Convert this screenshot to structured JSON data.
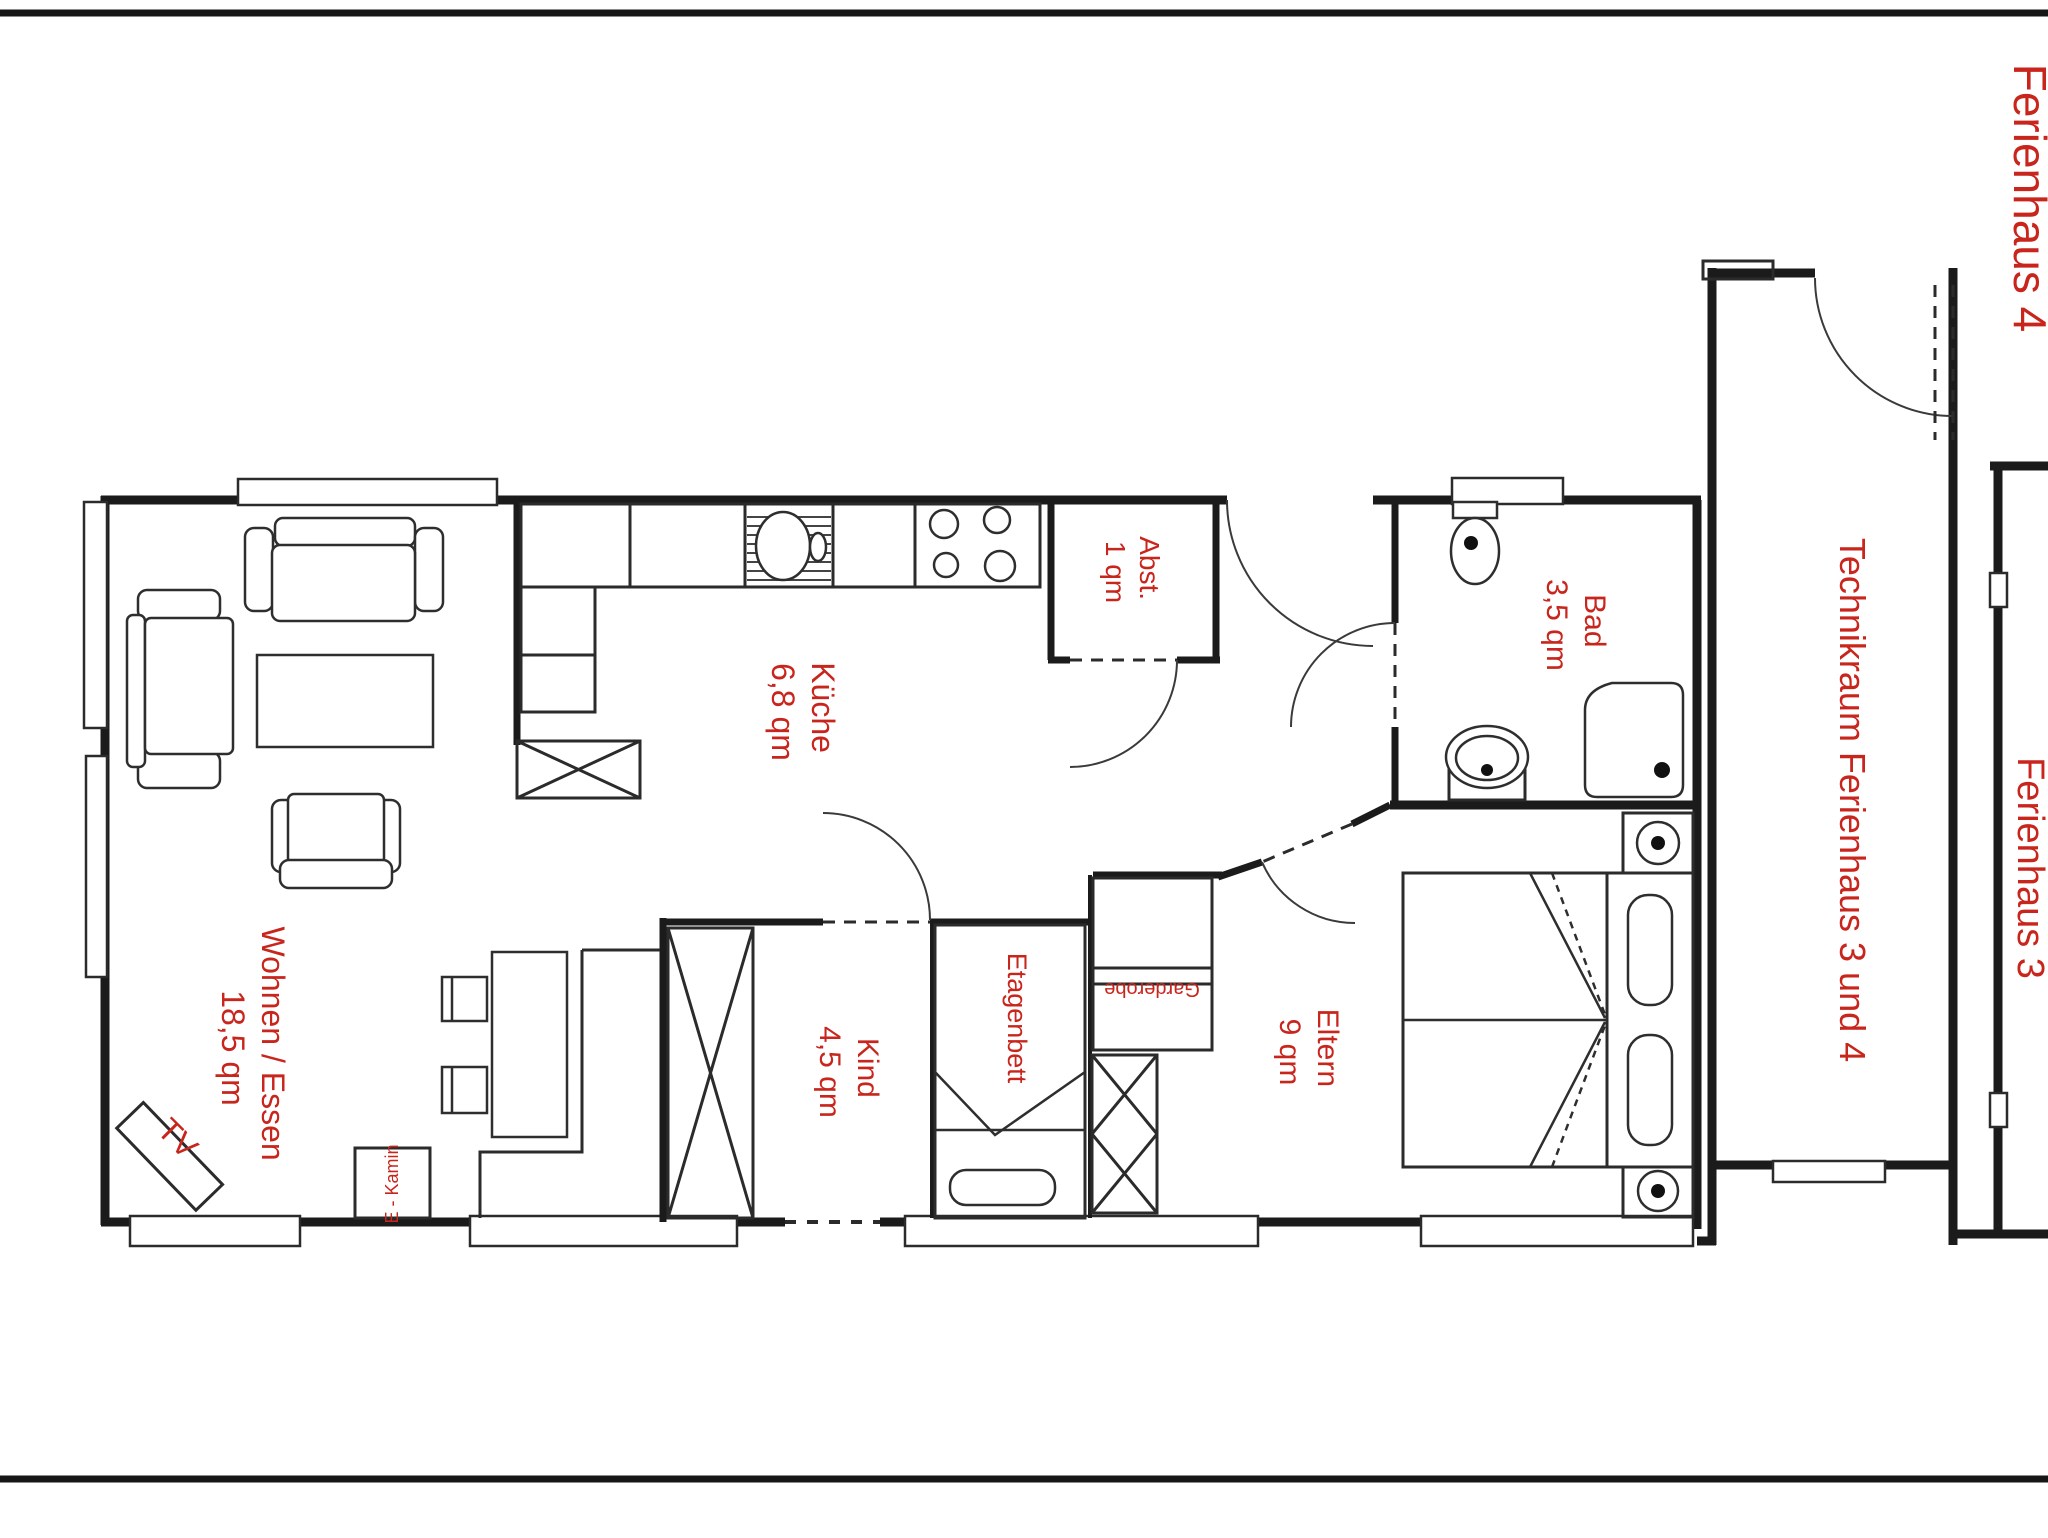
{
  "title": {
    "text": "Ferienhaus 4"
  },
  "colors": {
    "label_red": "#c8251d",
    "wall_black": "#1b1b1b"
  },
  "rooms": [
    {
      "id": "wohnen",
      "name": "Wohnen / Essen",
      "area": "18,5 qm"
    },
    {
      "id": "kueche",
      "name": "Küche",
      "area": "6,8 qm"
    },
    {
      "id": "abstellraum",
      "name": "Abst.",
      "area": "1 qm"
    },
    {
      "id": "bad",
      "name": "Bad",
      "area": "3,5 qm"
    },
    {
      "id": "kind",
      "name": "Kind",
      "area": "4,5 qm"
    },
    {
      "id": "eltern",
      "name": "Eltern",
      "area": "9 qm"
    },
    {
      "id": "technikraum",
      "name": "Technikraum Ferienhaus 3 und 4",
      "area": ""
    },
    {
      "id": "ferienhaus3",
      "name": "Ferienhaus 3",
      "area": ""
    }
  ],
  "furniture_labels": {
    "tv": "TV",
    "kamin": "E - Kamin",
    "etagenbett": "Etagenbett",
    "garderobe": "Garderobe"
  }
}
